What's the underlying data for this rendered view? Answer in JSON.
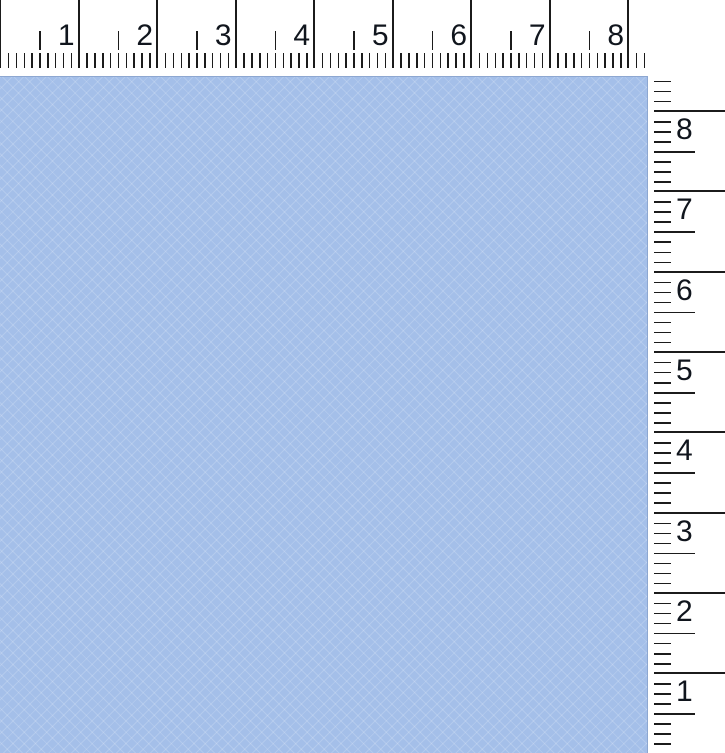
{
  "window": {
    "width_px": 725,
    "height_px": 753,
    "background": "#ffffff"
  },
  "canvas": {
    "fill": "#a4bfe9",
    "edge": "#8da7d1"
  },
  "horizontal_ruler": {
    "orientation": "top",
    "unit_labels": [
      "1",
      "2",
      "3",
      "4",
      "5",
      "6",
      "7",
      "8"
    ],
    "px_per_unit": 78.5,
    "minor_per_unit": 10,
    "length_px": 652,
    "tick_color": "#1b1b1b",
    "label_color": "#10151d"
  },
  "vertical_ruler": {
    "orientation": "right",
    "unit_labels": [
      "8",
      "7",
      "6",
      "5",
      "4",
      "3",
      "2",
      "1"
    ],
    "px_per_unit": 80.3,
    "minor_per_unit": 8,
    "origin_y_px": 111,
    "top_clip_px": 72,
    "bottom_clip_px": 752,
    "tick_color": "#1b1b1b",
    "label_color": "#10151d"
  }
}
